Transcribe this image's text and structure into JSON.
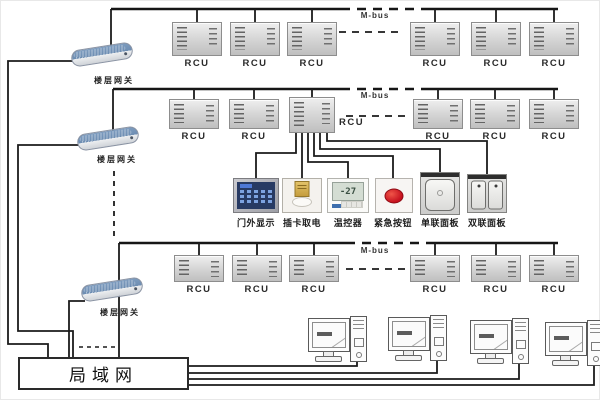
{
  "labels": {
    "rcu": "RCU",
    "mbus": "M-bus",
    "gateway": "楼层网关",
    "lan": "局域网"
  },
  "devices": [
    {
      "name": "door-display",
      "label": "门外显示"
    },
    {
      "name": "card-power-switch",
      "label": "插卡取电"
    },
    {
      "name": "thermostat",
      "label": "温控器",
      "screen": "-27"
    },
    {
      "name": "emergency-button",
      "label": "紧急按钮"
    },
    {
      "name": "single-gang-panel",
      "label": "单联面板"
    },
    {
      "name": "double-gang-panel",
      "label": "双联面板"
    }
  ],
  "network": {
    "floor_rows": 3,
    "rcu_count": 18,
    "gateway_count": 3,
    "workstation_count": 4
  }
}
